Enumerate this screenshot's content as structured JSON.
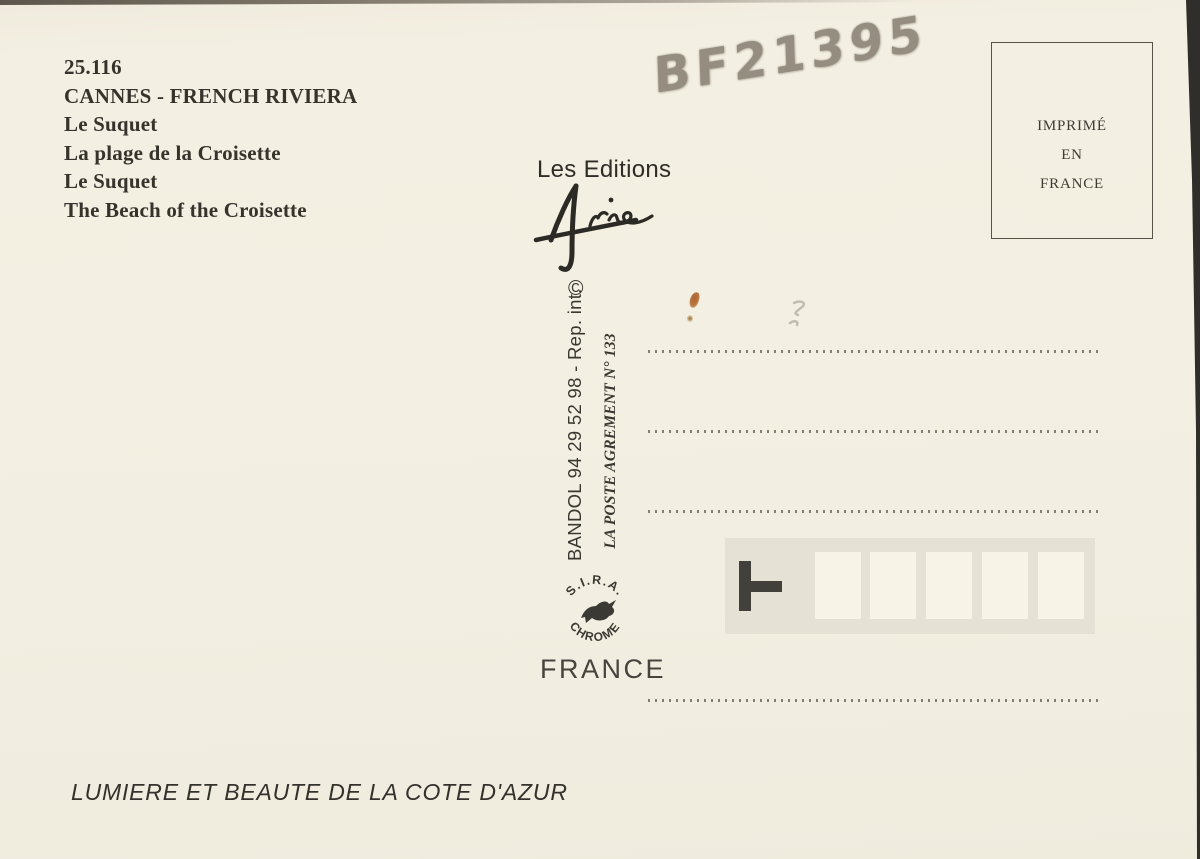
{
  "postcard": {
    "reference": "25.116",
    "title": "CANNES - FRENCH RIVIERA",
    "captions": [
      "Le Suquet",
      "La plage de la Croisette",
      "Le Suquet",
      "The Beach of the Croisette"
    ],
    "handwritten_code": "BF21395",
    "publisher": {
      "label": "Les Editions",
      "signature_name": "Aris",
      "copyright_symbol": "©"
    },
    "spine": {
      "contact": "BANDOL 94 29 52 98 - Rep. int.",
      "postal_agreement": "LA POSTE AGREMENT N° 133"
    },
    "printer_seal": {
      "arc_top": "S.I.R.A.",
      "arc_bottom": "CHROME"
    },
    "country_label": "FRANCE",
    "stamp_box": {
      "line1": "IMPRIMÉ",
      "line2": "EN",
      "line3": "FRANCE"
    },
    "footer_slogan": "LUMIERE ET BEAUTE DE LA COTE D'AZUR",
    "address_area": {
      "dotted_lines": 4,
      "postal_code_cells": 5
    }
  },
  "colors": {
    "card_background": "#f3f0e3",
    "ink": "#35332c",
    "pencil_gray": "#8b8375",
    "postal_band": "#e5e2d5",
    "postal_cell": "#f7f4e7",
    "rust_stain": "#b4692d",
    "scan_edge": "#2f2e2a"
  }
}
